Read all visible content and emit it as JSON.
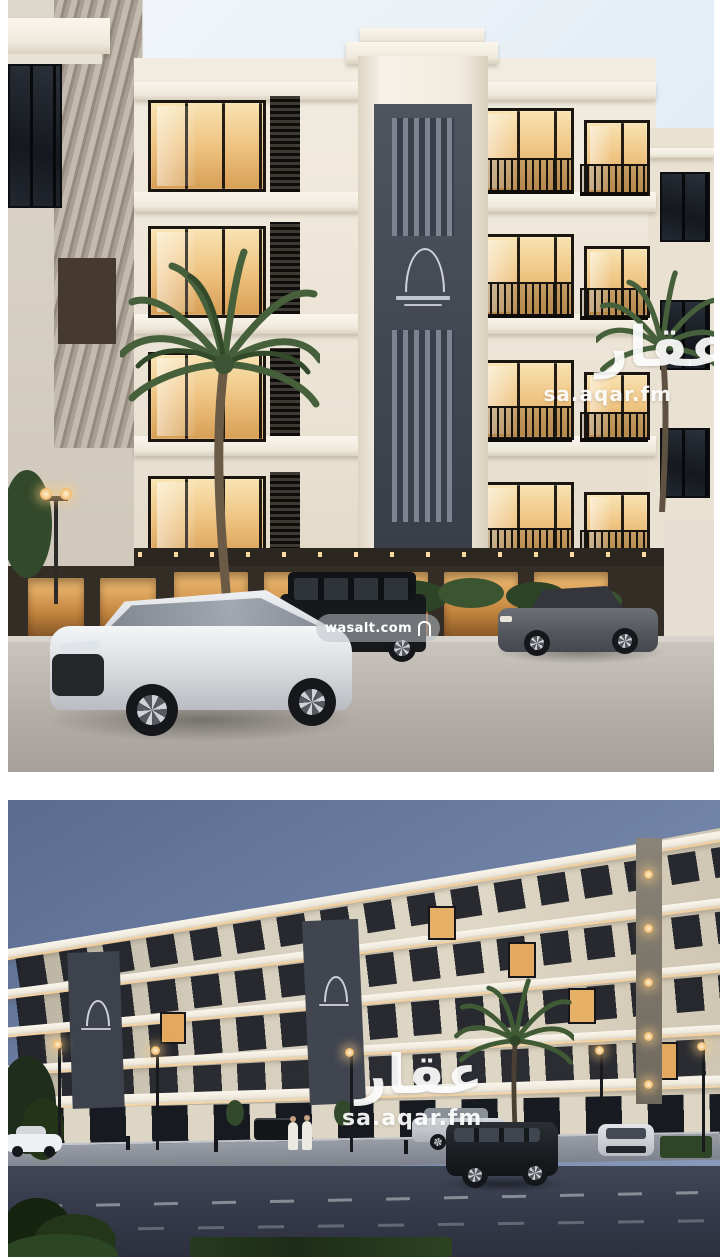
{
  "page": {
    "background_color": "#ffffff"
  },
  "listing_photos": {
    "photo_count": 2,
    "top_photo": {
      "scene": "daytime exterior render of white classical apartment building with palm trees and parked cars",
      "watermark": {
        "brand_arabic": "عقار",
        "site": "sa.aqar.fm"
      },
      "wasalt_watermark": {
        "site": "wasalt.com"
      },
      "palette": {
        "sky": "#e4eef6",
        "facade": "#efe8da",
        "feature_panel": "#474c56",
        "window_glow": "#eec07c",
        "pavement": "#b5b0a9"
      }
    },
    "bottom_photo": {
      "scene": "night exterior render of the same building from the street with streetlights, parked SUVs and pedestrians",
      "watermark": {
        "brand_arabic": "عقار",
        "site": "sa.aqar.fm"
      },
      "palette": {
        "sky": "#6d80a4",
        "facade": "#ded6c5",
        "street": "#3a3f4e",
        "window_glow": "#e8b877"
      }
    }
  }
}
